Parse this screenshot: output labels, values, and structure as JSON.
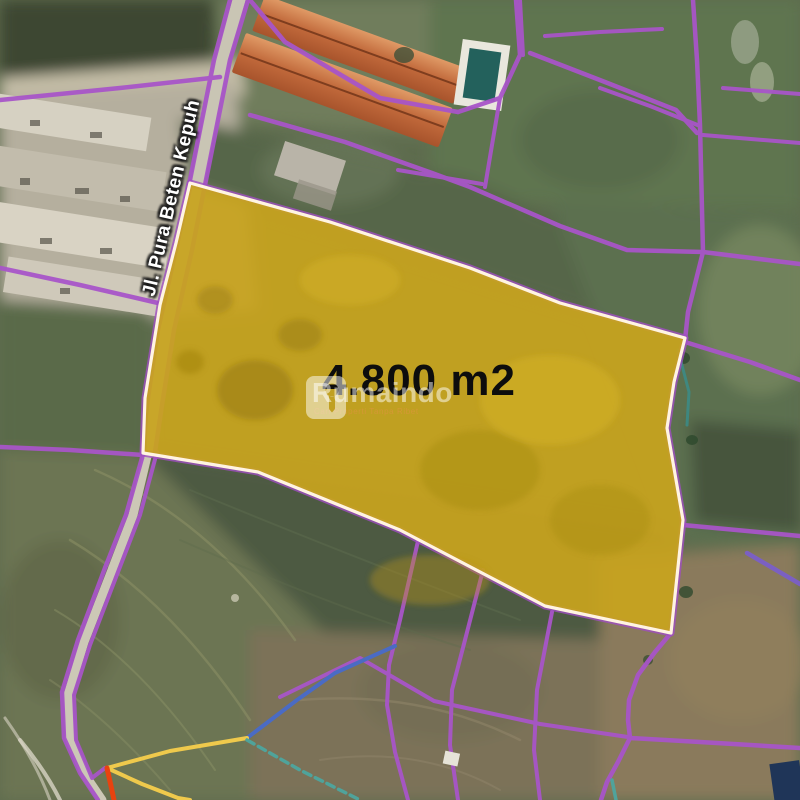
{
  "map": {
    "plot": {
      "area_label": "4.800 m2"
    },
    "road": {
      "label": "Jl. Pura Beten Kepuh"
    },
    "watermark": {
      "brand": "Rumaindo",
      "tagline": "Cari Properti Tanpa Ribet"
    },
    "colors": {
      "plot_fill": "#C8A41E",
      "plot_border_white": "#FFF4E2",
      "boundary_purple": "#A855C8",
      "road_surface": "#C9C5B4",
      "line_blue": "#4A6BC4",
      "line_yellow": "#EFC94C",
      "line_red": "#E8430F",
      "line_teal": "#4FA39B",
      "roof_orange": "#C1693B",
      "pool_teal": "#23615C",
      "area_text": "#0D0D0D"
    }
  }
}
